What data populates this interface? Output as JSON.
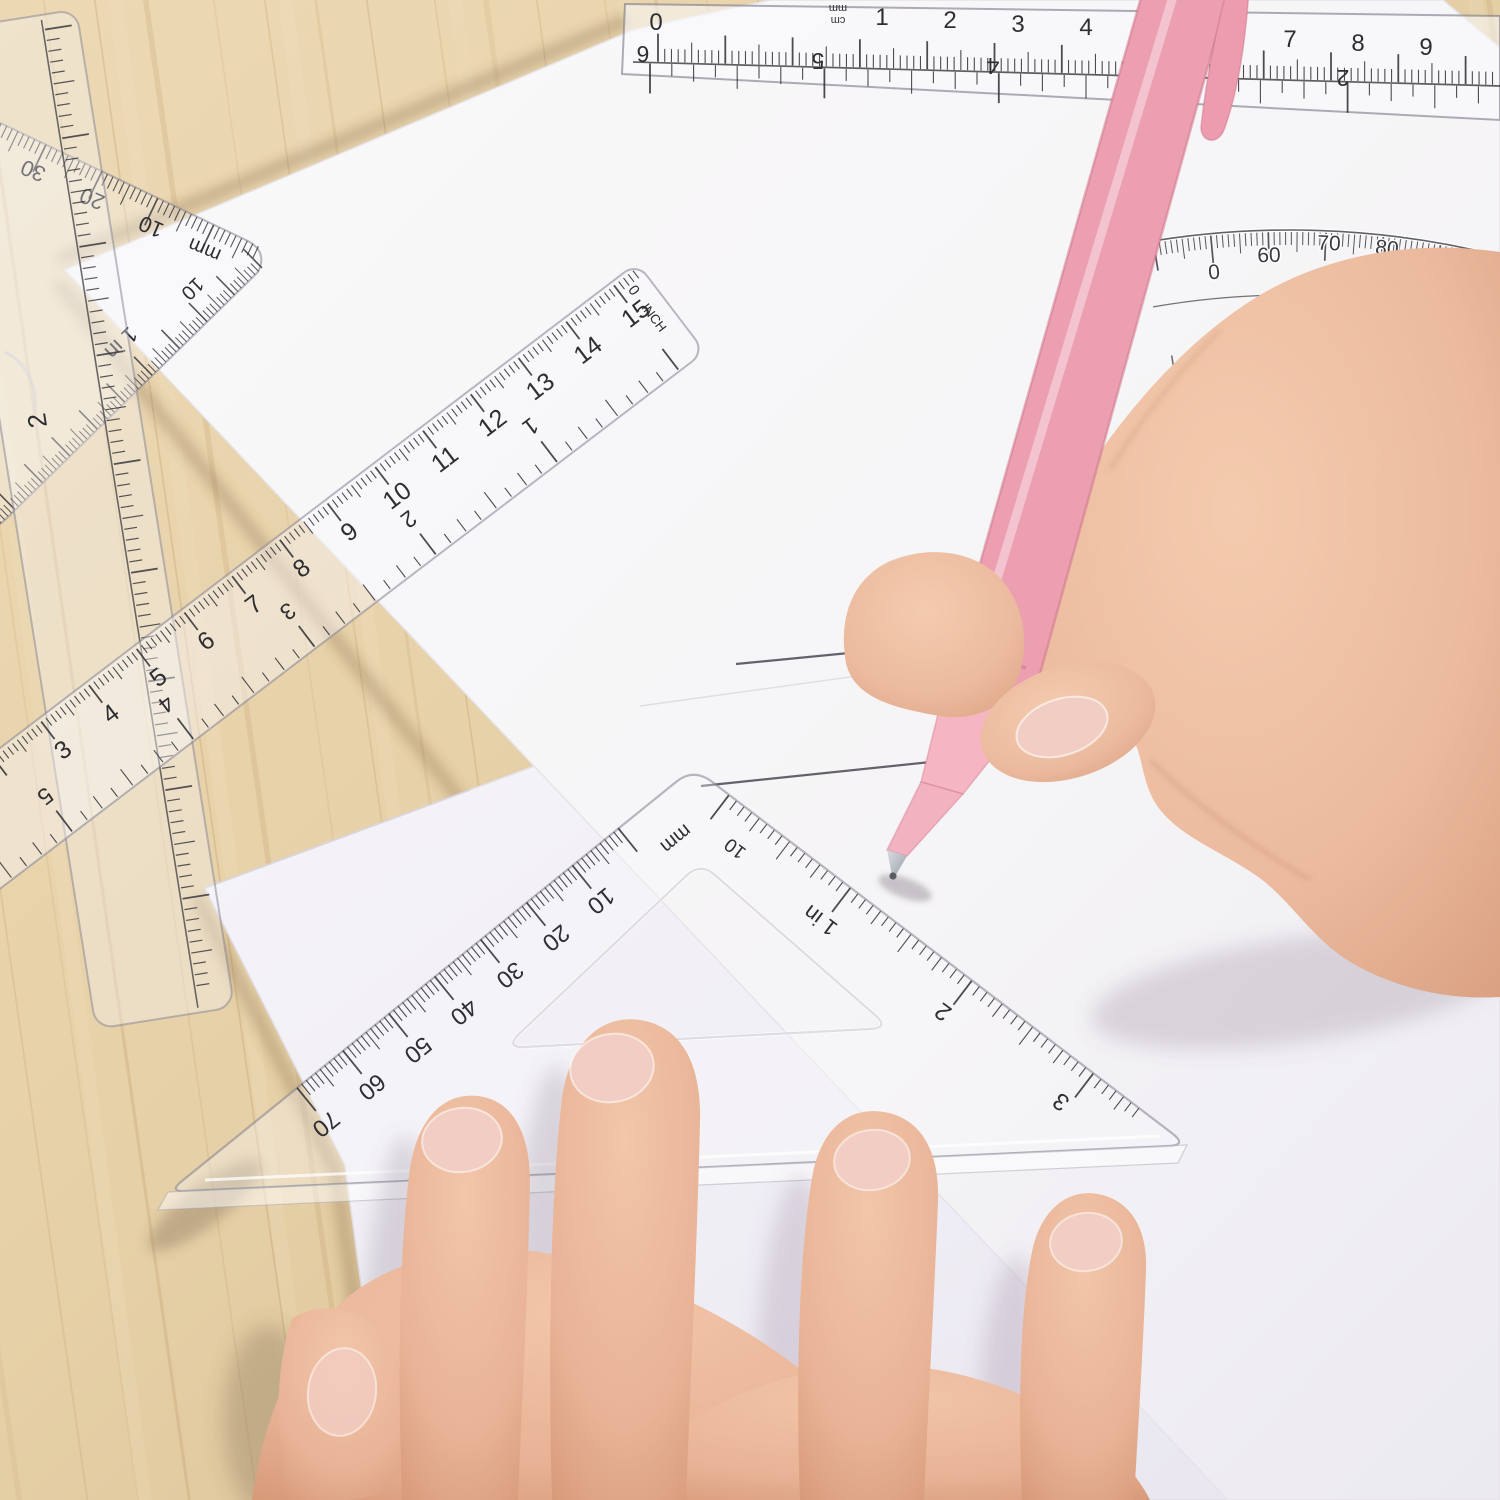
{
  "colors": {
    "wood": "#e6d0a7",
    "wood_dark": "#d7bd92",
    "wood_grain": "#b98f5c",
    "paper_top": "#f8f7f8",
    "paper_bottom": "#f1eff5",
    "plastic_stroke": "#8d8d99",
    "scale_ink": "#2e2e33",
    "protractor_ink": "#3a3a42",
    "pencil_line": "#56525e",
    "pen_body": "#f6b5c2",
    "pen_body_dark": "#ec9cae",
    "pen_highlight": "#fcd9e0",
    "pen_metal": "#b9bdc6",
    "skin": "#ecbb9f",
    "skin_deep": "#d89d7e",
    "nail": "#f2cdc3"
  },
  "instruments": {
    "top_ruler": {
      "cm_labels": [
        "0",
        "1",
        "2",
        "3",
        "4",
        "5",
        "6",
        "7",
        "8",
        "9"
      ],
      "unit_labels": [
        "mm",
        "cm"
      ],
      "inch_labels": [
        "6",
        "5",
        "4",
        "3",
        "2"
      ]
    },
    "corner_set_square": {
      "mm_labels": [
        "30",
        "20",
        "10",
        "mm"
      ],
      "inch_labels": [
        "10",
        "1 in"
      ]
    },
    "left_ruler": {
      "labels": [
        "2"
      ]
    },
    "middle_ruler": {
      "cm_labels": [
        "3",
        "4",
        "5",
        "6",
        "7",
        "8",
        "9",
        "10",
        "11",
        "12",
        "13",
        "14",
        "15"
      ],
      "inch_labels": [
        "1",
        "2",
        "3",
        "4",
        "5"
      ],
      "end_labels": [
        "0",
        "INCH"
      ]
    },
    "bottom_set_square": {
      "mm_labels": [
        "mm",
        "10",
        "20",
        "30",
        "40",
        "50",
        "60",
        "70"
      ],
      "inch_labels": [
        "10",
        "1 in",
        "2",
        "3"
      ]
    },
    "protractor": {
      "outer_labels": [
        "0",
        "60",
        "70",
        "80",
        "90",
        "100"
      ],
      "inner_labels": [
        "120",
        "110",
        "100",
        "80",
        "70"
      ]
    }
  }
}
